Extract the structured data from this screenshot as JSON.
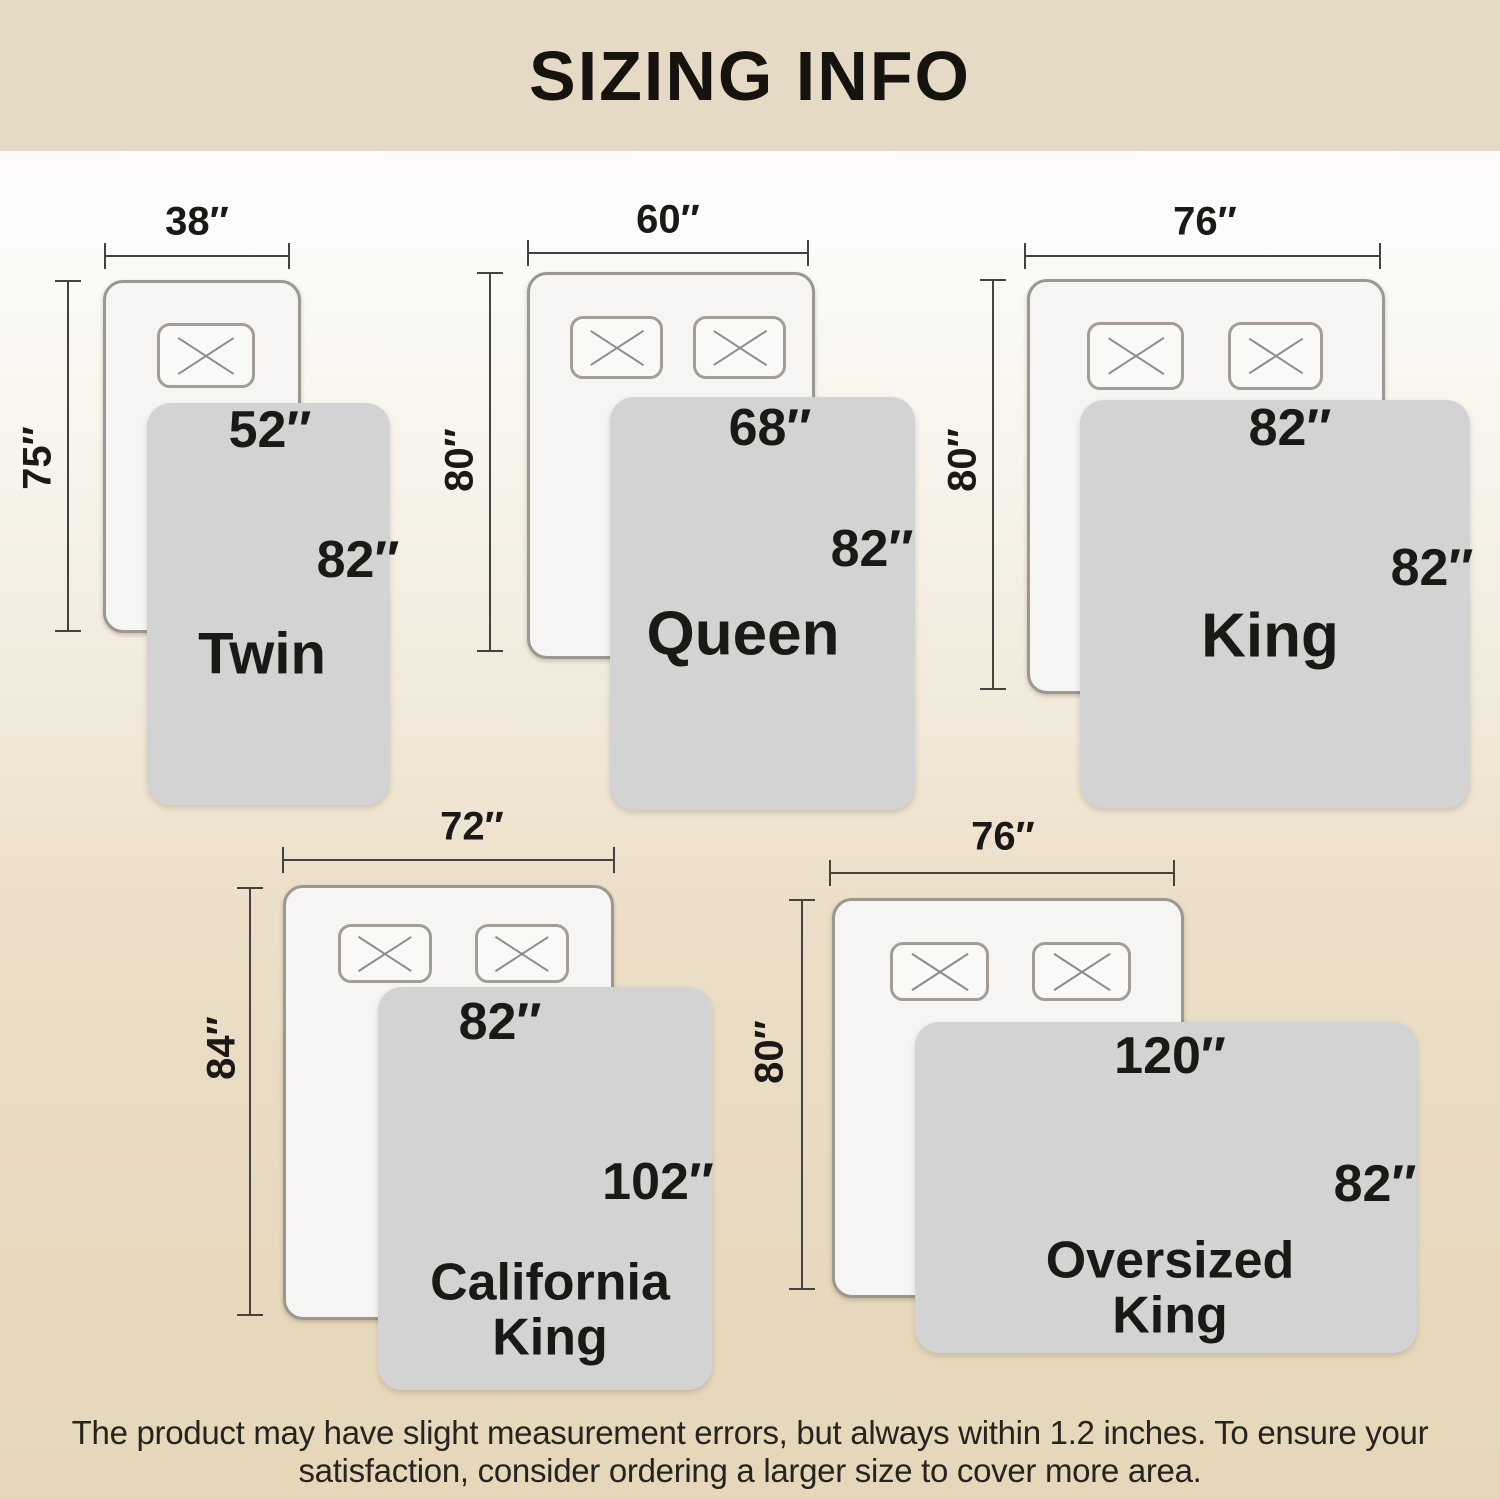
{
  "header": {
    "title": "SIZING INFO"
  },
  "colors": {
    "header_bg": "#e5dac6",
    "page_top": "#fbfaf8",
    "page_bottom": "#e6d7ba",
    "mattress_fill": "#f6f5f3",
    "mattress_border": "#9b9791",
    "blanket_fill": "#d2d3d2",
    "dimension_line": "#44423e",
    "text": "#1c1a17"
  },
  "diagrams": [
    {
      "label": "Twin",
      "pillows": 1,
      "bed": {
        "width": "38″",
        "height": "75″"
      },
      "blanket": {
        "width": "52″",
        "height": "82″"
      }
    },
    {
      "label": "Queen",
      "pillows": 2,
      "bed": {
        "width": "60″",
        "height": "80″"
      },
      "blanket": {
        "width": "68″",
        "height": "82″"
      }
    },
    {
      "label": "King",
      "pillows": 2,
      "bed": {
        "width": "76″",
        "height": "80″"
      },
      "blanket": {
        "width": "82″",
        "height": "82″"
      }
    },
    {
      "label": "California King",
      "pillows": 2,
      "bed": {
        "width": "72″",
        "height": "84″"
      },
      "blanket": {
        "width": "82″",
        "height": "102″"
      }
    },
    {
      "label": "Oversized King",
      "pillows": 2,
      "bed": {
        "width": "76″",
        "height": "80″"
      },
      "blanket": {
        "width": "120″",
        "height": "82″"
      }
    }
  ],
  "footer": {
    "lines": [
      "The product may have slight measurement errors, but always within 1.2 inches. To ensure your",
      "satisfaction, consider ordering a larger size to cover more area."
    ]
  }
}
